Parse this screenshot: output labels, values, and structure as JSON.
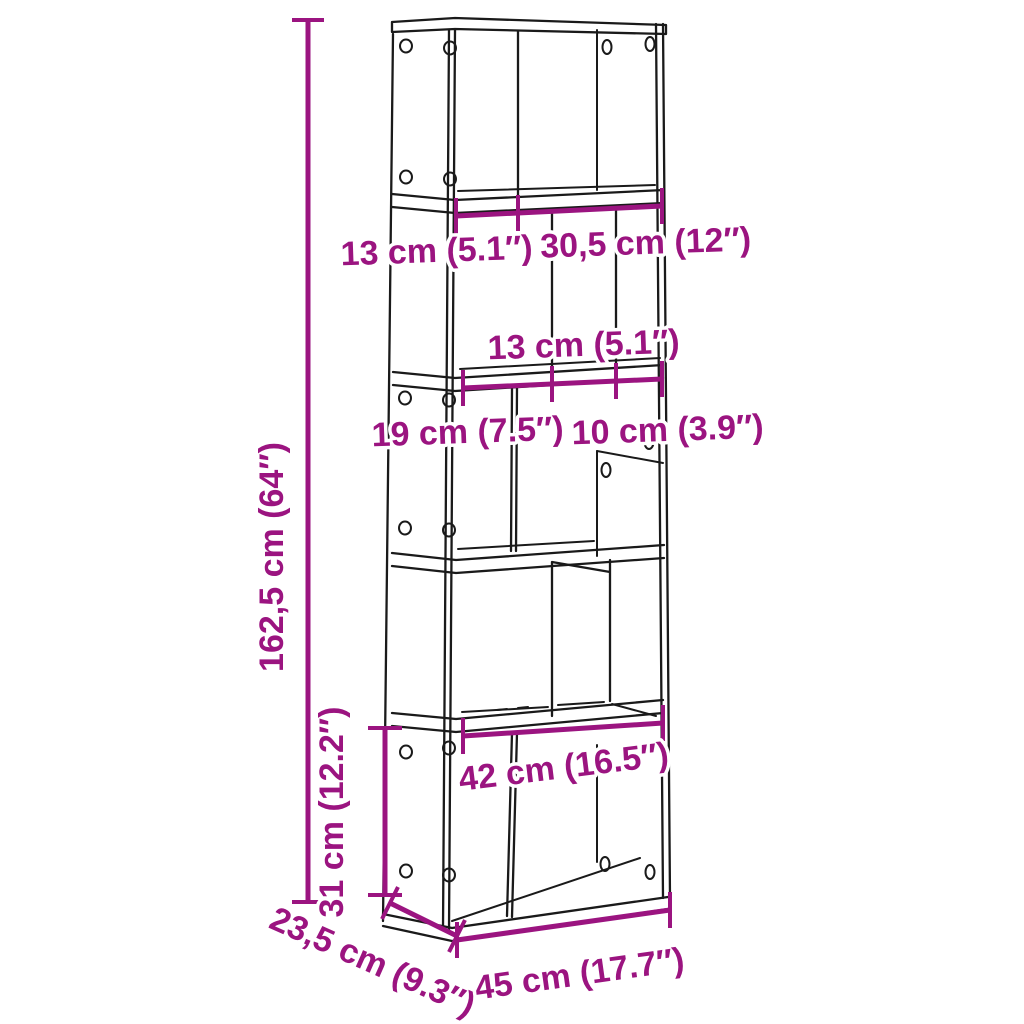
{
  "diagram": {
    "type": "furniture-dimension-diagram",
    "subject": "5-tier bookcase with dimension annotations",
    "background_color": "#FFFFFF",
    "line_color": "#1A1A1A",
    "accent_color": "#9B1480",
    "dimensions": {
      "total_height": "162,5 cm (64″)",
      "base_section_height": "31 cm (12.2″)",
      "top_left_compartment_width": "13 cm (5.1″)",
      "top_right_compartment_width": "30,5 cm (12″)",
      "middle_compartment_width": "13 cm (5.1″)",
      "middle_left_compartment_width": "19 cm (7.5″)",
      "middle_right_compartment_width": "10 cm (3.9″)",
      "inner_shelf_width": "42 cm (16.5″)",
      "total_depth": "23,5 cm (9.3″)",
      "total_width": "45 cm (17.7″)"
    }
  }
}
